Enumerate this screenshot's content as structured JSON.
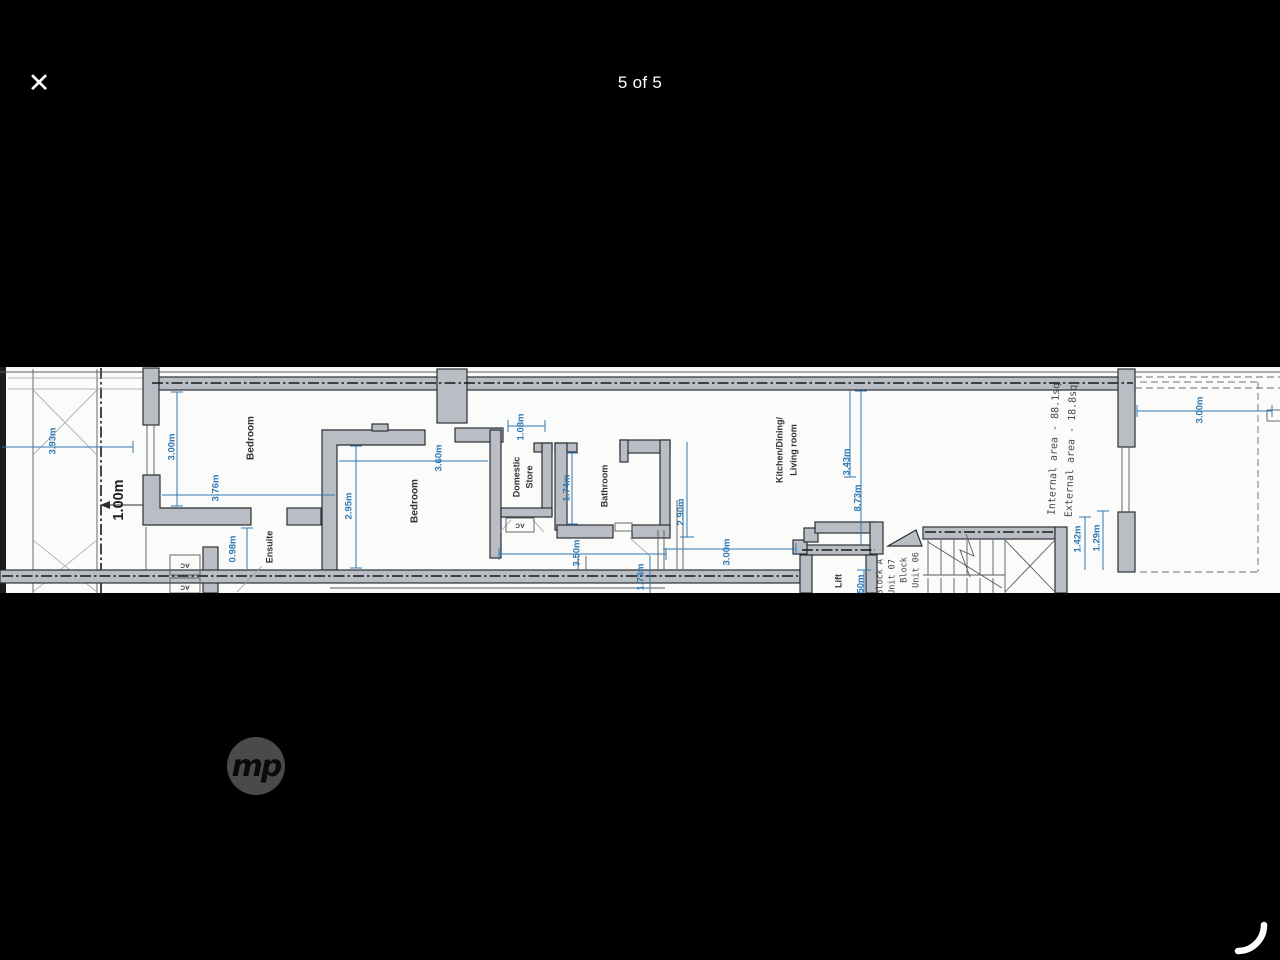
{
  "viewer": {
    "counter": "5 of 5",
    "close_glyph": "✕",
    "watermark": "mp"
  },
  "colors": {
    "background": "#000000",
    "paper": "#fbfbfa",
    "wall_fill": "#b9bdc4",
    "wall_line": "#2b2e34",
    "dimension_blue": "#2d7ab6",
    "text_dark": "#2f3135",
    "watermark_gray": "#4a4a4a"
  },
  "plan": {
    "rooms": {
      "bedroom_left": "Bedroom",
      "ensuite": "Ensuite",
      "bedroom_mid": "Bedroom",
      "domestic_store_line1": "Domestic",
      "domestic_store_line2": "Store",
      "bathroom": "Bathroom",
      "kitchen_line1": "Kitchen/Dining/",
      "kitchen_line2": "Living room",
      "lift": "Lift"
    },
    "labels": {
      "ac1": "AC",
      "ac2": "AC",
      "ac3": "AC"
    },
    "dimensions": {
      "lightwell_width": "3.93m",
      "wall_offset": "1.00m",
      "bedroom_left_width": "3.00m",
      "bedroom_left_depth": "3.76m",
      "ensuite_width": "0.98m",
      "bedroom_mid_width": "2.95m",
      "bedroom_mid_depth": "3.60m",
      "store_width": "1.08m",
      "bathroom_width": "1.74m",
      "bathroom_span": "3.50m",
      "corridor": "1.73m",
      "kitchen_width": "2.90m",
      "kitchen_span": "3.00m",
      "kitchen_depth": "3.43m",
      "unit_length": "8.73m",
      "lift_width": "1.50m",
      "stair_a": "1.42m",
      "stair_b": "1.29m",
      "terrace_width": "3.00m"
    },
    "annotations": {
      "internal_area": "Internal area - 88.1sq",
      "external_area": "External area - 18.8sq",
      "block_left_line1": "Block A",
      "block_left_line2": "Unit 07",
      "block_right_line1": "Block",
      "block_right_line2": "Unit 06"
    }
  }
}
